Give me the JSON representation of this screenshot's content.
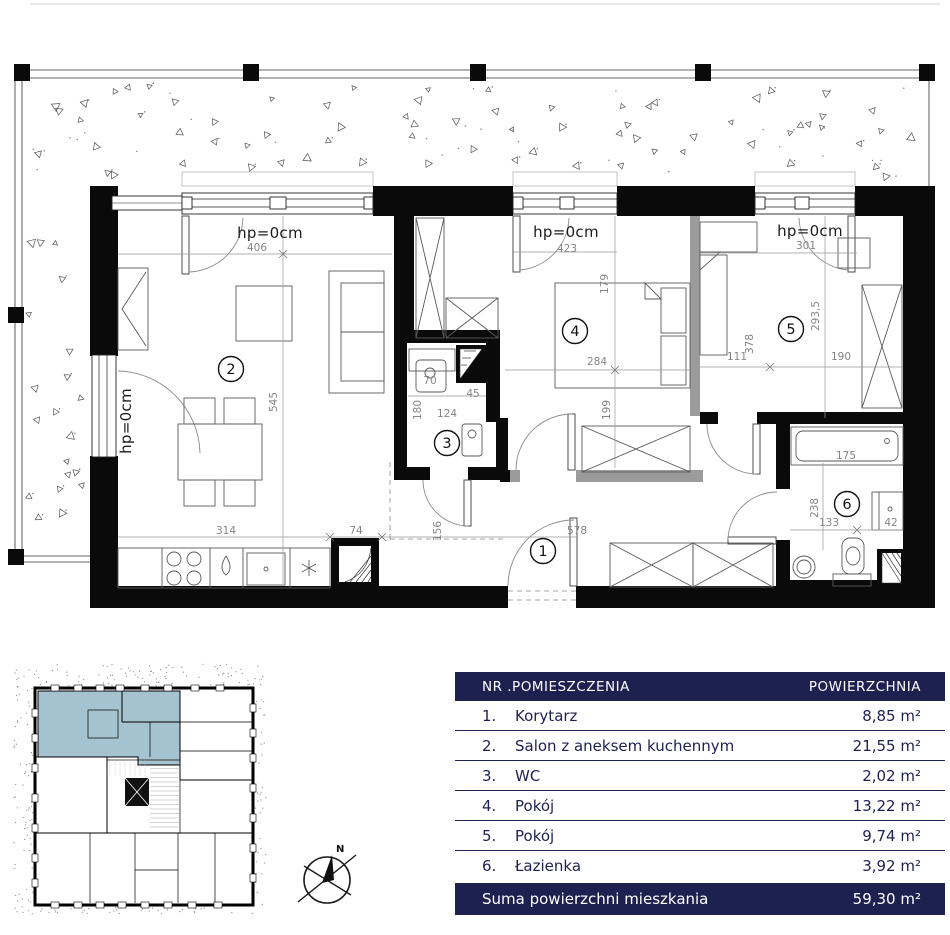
{
  "colors": {
    "accent_navy": "#1d2150",
    "highlight_blue": "#a4c2cf",
    "wall_black": "#0a0a0a",
    "gray_wall": "#9b9b9b"
  },
  "plan": {
    "labels": [
      {
        "t": "hp=0cm",
        "x": 270,
        "y": 238,
        "cls": "hp"
      },
      {
        "t": "hp=0cm",
        "x": 566,
        "y": 237,
        "cls": "hp"
      },
      {
        "t": "hp=0cm",
        "x": 810,
        "y": 236,
        "cls": "hp"
      },
      {
        "t": "hp=0cm",
        "x": 131,
        "y": 421,
        "cls": "hp",
        "r": -90
      },
      {
        "t": "406",
        "x": 257,
        "y": 251,
        "cls": "dim"
      },
      {
        "t": "545",
        "x": 277,
        "y": 402,
        "cls": "dim",
        "r": -90
      },
      {
        "t": "423",
        "x": 567,
        "y": 252,
        "cls": "dim"
      },
      {
        "t": "179",
        "x": 608,
        "y": 284,
        "cls": "dim",
        "r": -90
      },
      {
        "t": "284",
        "x": 597,
        "y": 365,
        "cls": "dim"
      },
      {
        "t": "199",
        "x": 610,
        "y": 410,
        "cls": "dim",
        "r": -90
      },
      {
        "t": "301",
        "x": 806,
        "y": 249,
        "cls": "dim"
      },
      {
        "t": "293,5",
        "x": 819,
        "y": 316,
        "cls": "dim",
        "r": -90
      },
      {
        "t": "378",
        "x": 753,
        "y": 344,
        "cls": "dim",
        "r": -90
      },
      {
        "t": "111",
        "x": 737,
        "y": 360,
        "cls": "dim"
      },
      {
        "t": "190",
        "x": 841,
        "y": 360,
        "cls": "dim"
      },
      {
        "t": "70",
        "x": 430,
        "y": 384,
        "cls": "dim"
      },
      {
        "t": "45",
        "x": 473,
        "y": 397,
        "cls": "dim"
      },
      {
        "t": "180",
        "x": 421,
        "y": 410,
        "cls": "dim",
        "r": -90
      },
      {
        "t": "124",
        "x": 447,
        "y": 417,
        "cls": "dim"
      },
      {
        "t": "314",
        "x": 226,
        "y": 534,
        "cls": "dim"
      },
      {
        "t": "74",
        "x": 356,
        "y": 534,
        "cls": "dim"
      },
      {
        "t": "156",
        "x": 441,
        "y": 531,
        "cls": "dim",
        "r": -90
      },
      {
        "t": "578",
        "x": 577,
        "y": 534,
        "cls": "dim"
      },
      {
        "t": "175",
        "x": 846,
        "y": 459,
        "cls": "dim"
      },
      {
        "t": "238",
        "x": 818,
        "y": 508,
        "cls": "dim",
        "r": -90
      },
      {
        "t": "133",
        "x": 829,
        "y": 526,
        "cls": "dim"
      },
      {
        "t": "42",
        "x": 891,
        "y": 526,
        "cls": "dim"
      }
    ],
    "room_markers": [
      {
        "n": "1",
        "x": 543,
        "y": 551
      },
      {
        "n": "2",
        "x": 231,
        "y": 369
      },
      {
        "n": "3",
        "x": 447,
        "y": 443
      },
      {
        "n": "4",
        "x": 575,
        "y": 331
      },
      {
        "n": "5",
        "x": 791,
        "y": 329
      },
      {
        "n": "6",
        "x": 847,
        "y": 504
      }
    ]
  },
  "legend_table": {
    "header": {
      "col_rooms": "NR .POMIESZCZENIA",
      "col_area": "POWIERZCHNIA"
    },
    "rows": [
      {
        "no": "1.",
        "name": "Korytarz",
        "area": "8,85 m²"
      },
      {
        "no": "2.",
        "name": "Salon z aneksem kuchennym",
        "area": "21,55 m²"
      },
      {
        "no": "3.",
        "name": "WC",
        "area": "2,02 m²"
      },
      {
        "no": "4.",
        "name": "Pokój",
        "area": "13,22 m²"
      },
      {
        "no": "5.",
        "name": "Pokój",
        "area": "9,74 m²"
      },
      {
        "no": "6.",
        "name": "Łazienka",
        "area": "3,92 m²"
      }
    ],
    "footer": {
      "label": "Suma powierzchni mieszkania",
      "total": "59,30 m²"
    }
  },
  "compass": {
    "north_label": "N"
  }
}
